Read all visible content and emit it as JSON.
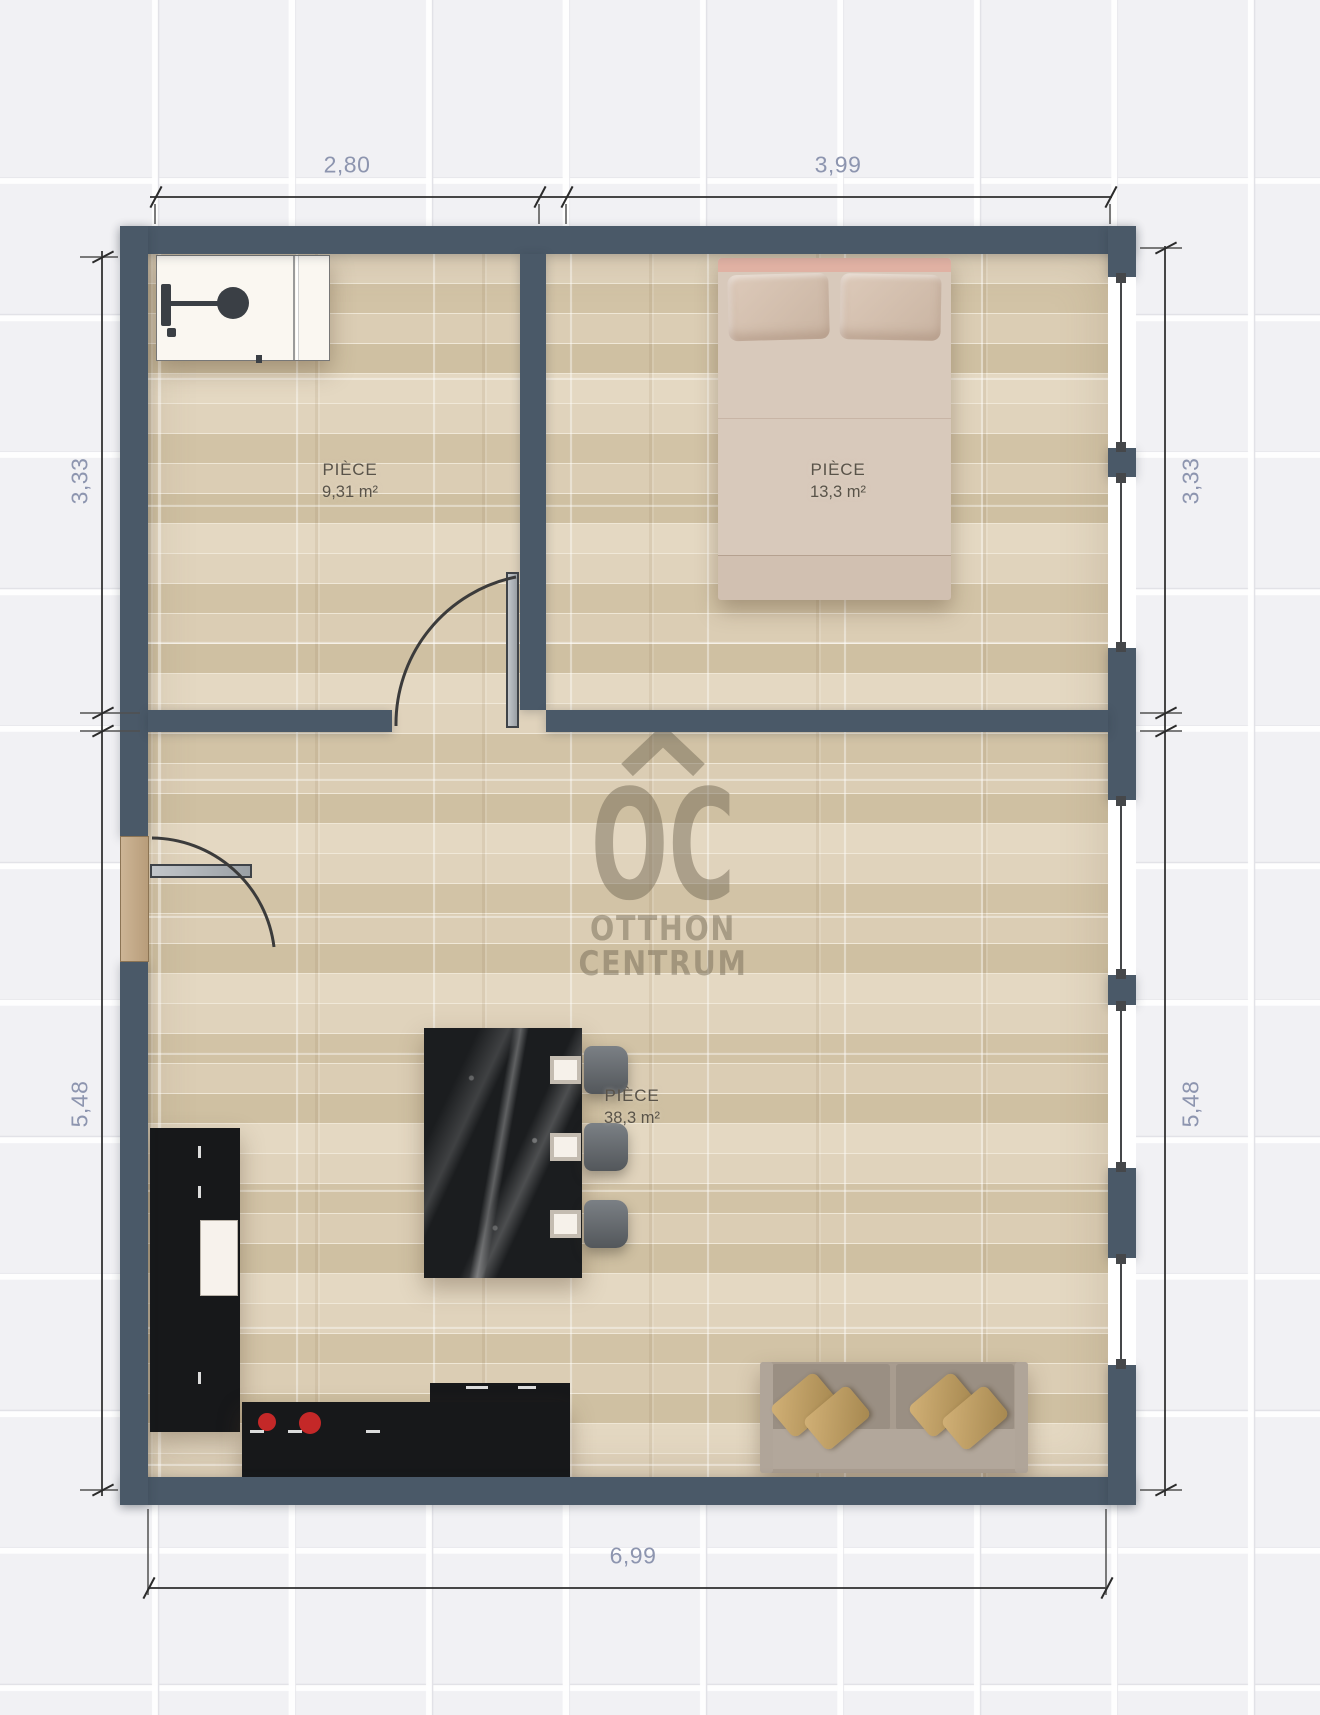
{
  "rooms": [
    {
      "name": "PIÈCE",
      "area": "9,31 m²"
    },
    {
      "name": "PIÈCE",
      "area": "13,3 m²"
    },
    {
      "name": "PIÈCE",
      "area": "38,3 m²"
    }
  ],
  "dimensions": {
    "top": [
      "2,80",
      "3,99"
    ],
    "left": [
      "3,33",
      "5,48"
    ],
    "right": [
      "3,33",
      "5,48"
    ],
    "bottom": [
      "6,99"
    ]
  },
  "watermark": {
    "initials": "OC",
    "line1": "OTTHON",
    "line2": "CENTRUM"
  },
  "colors": {
    "wall": "#4a5968",
    "floor": "#d9cbb2",
    "dimension_text": "#8d95af",
    "room_label_text": "#595349",
    "burner_red": "#c42828",
    "watermark": "#716753",
    "door_leaf": "#aeb2b7",
    "window_frame": "#45474a",
    "island_marble": "#1b1d1f",
    "kitchen_counter": "#17181a",
    "sofa": "#a89c8f",
    "bed": "#d8c9bb",
    "bed_headboard": "#e0b1a3"
  }
}
